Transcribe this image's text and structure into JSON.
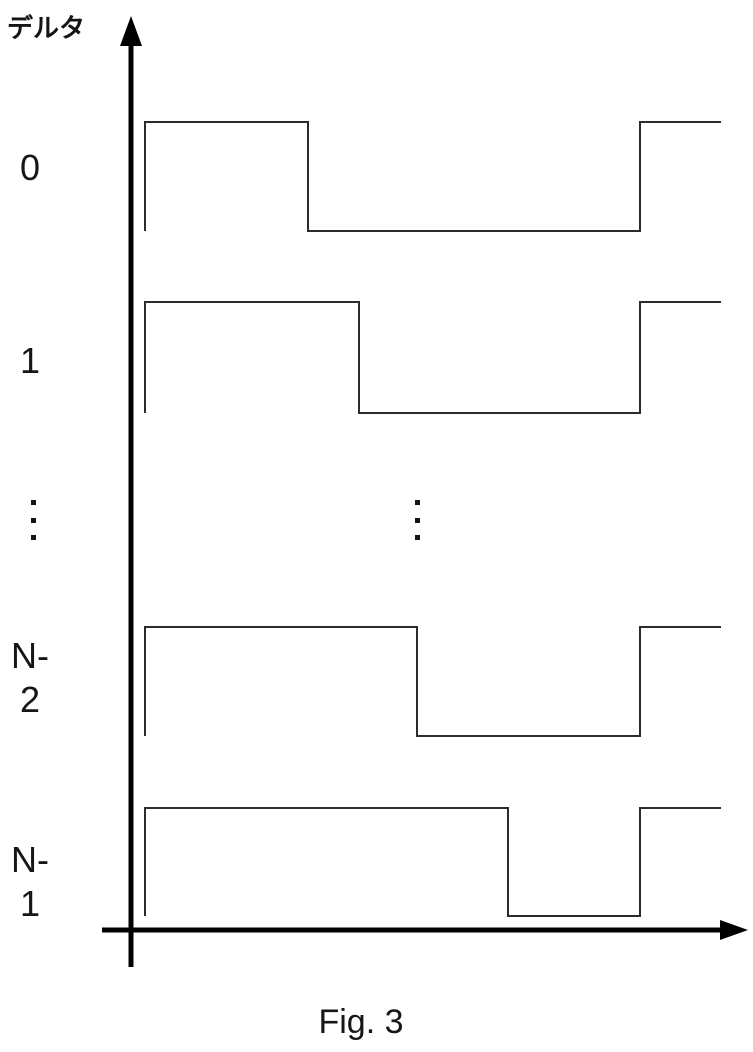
{
  "figure": {
    "y_axis_label": "デルタ",
    "caption": "Fig. 3",
    "background": "#ffffff",
    "axis_color": "#000000",
    "line_color": "#2b2b2b"
  },
  "icons": {
    "vertical_ellipsis": "⋮",
    "up_arrow": "↑",
    "right_arrow": "→"
  },
  "chart_data": {
    "type": "line",
    "subtype": "timing-diagram",
    "title": "Fig. 3",
    "y_axis_label": "デルタ",
    "xlabel": "",
    "ylabel": "デルタ",
    "grid": false,
    "description": "N square waveforms (delta index 0 .. N-1). Each starts high at the same time, falls at a progressively later time as the index increases, stays low, then all rise together near the end of the period.",
    "rows": [
      {
        "label": "0",
        "x_start": 145,
        "x_fall": 308,
        "x_rise": 640,
        "x_end": 721,
        "y_high": 122,
        "y_low": 231
      },
      {
        "label": "1",
        "x_start": 145,
        "x_fall": 359,
        "x_rise": 640,
        "x_end": 721,
        "y_high": 302,
        "y_low": 413
      },
      {
        "label": "N-2",
        "x_start": 145,
        "x_fall": 417,
        "x_rise": 640,
        "x_end": 721,
        "y_high": 627,
        "y_low": 736
      },
      {
        "label": "N-1",
        "x_start": 145,
        "x_fall": 508,
        "x_rise": 640,
        "x_end": 721,
        "y_high": 808,
        "y_low": 916
      }
    ],
    "ellipsis": {
      "symbol": "⋮",
      "columns": [
        {
          "x": 31,
          "y": 500
        },
        {
          "x": 415,
          "y": 500
        }
      ]
    },
    "axes": {
      "vertical": {
        "x": 131,
        "y_top": 16,
        "y_bottom": 967,
        "thickness": 5,
        "arrow_half_width": 11,
        "arrow_length": 30
      },
      "horizontal": {
        "y": 930,
        "x_left": 102,
        "x_right": 748,
        "thickness": 5,
        "arrow_half_height": 10,
        "arrow_length": 28
      }
    }
  }
}
